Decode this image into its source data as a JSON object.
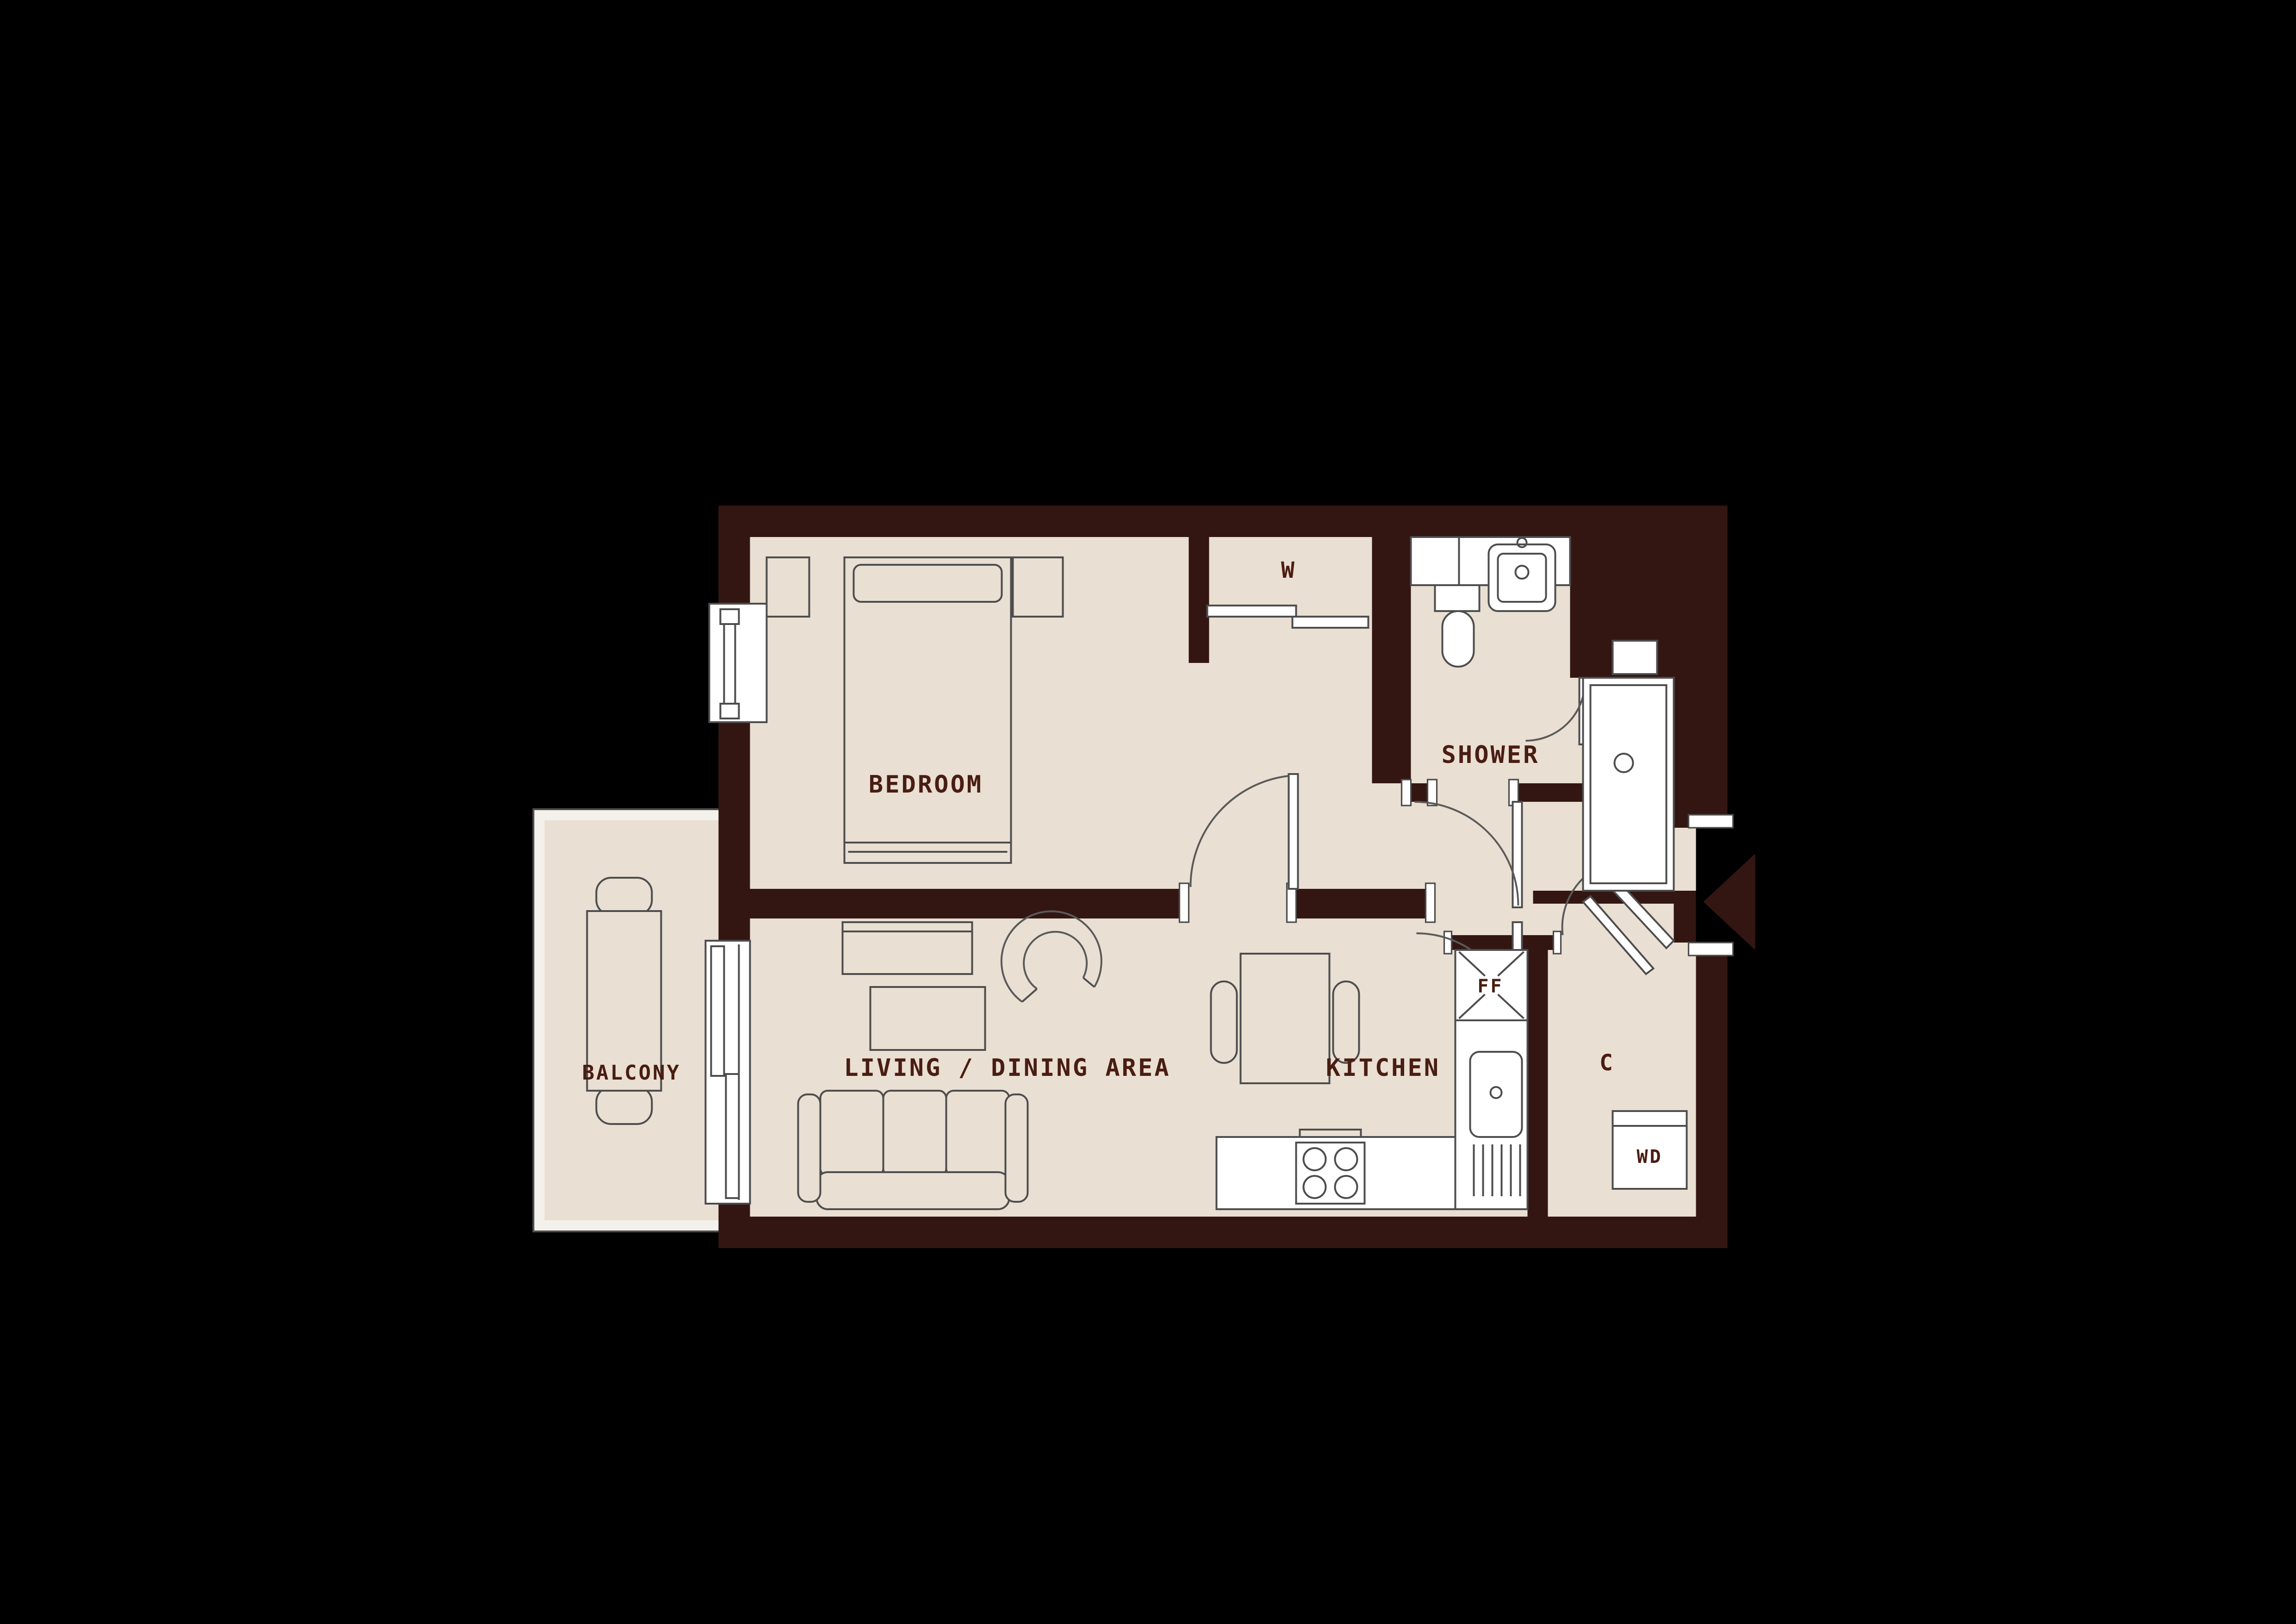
{
  "plan": {
    "title": "apartment-floor-plan",
    "rooms": {
      "bedroom": {
        "label": "BEDROOM"
      },
      "wardrobe": {
        "label": "W"
      },
      "shower": {
        "label": "SHOWER"
      },
      "balcony": {
        "label": "BALCONY"
      },
      "living_dining": {
        "label": "LIVING / DINING AREA"
      },
      "kitchen": {
        "label": "KITCHEN"
      },
      "fridge_freezer": {
        "label": "FF"
      },
      "cupboard": {
        "label": "C"
      },
      "washer_dryer": {
        "label": "WD"
      }
    },
    "icons": {
      "entry_arrow": "left-pointing-triangle"
    },
    "colors": {
      "background": "#000000",
      "wall": "#331612",
      "floor": "#e9dfd2",
      "fixture": "#ffffff",
      "label": "#4a1d12"
    }
  }
}
